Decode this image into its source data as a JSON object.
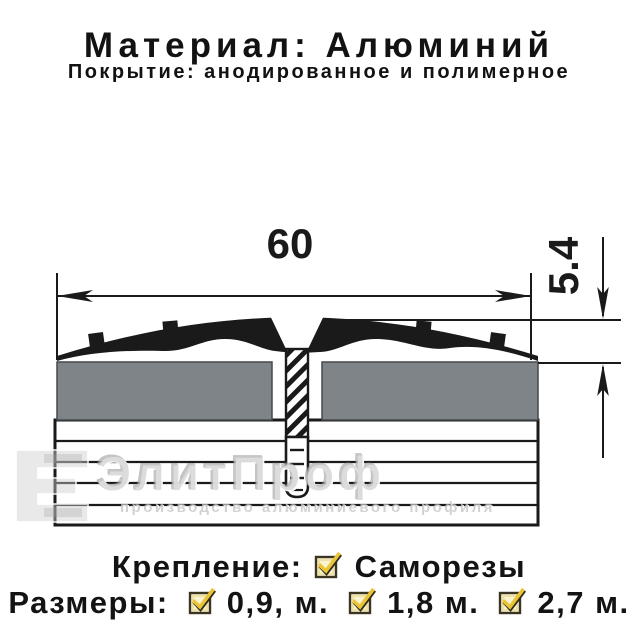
{
  "header": {
    "title": "Материал: Алюминий",
    "subtitle": "Покрытие: анодированное и полимерное"
  },
  "diagram": {
    "type": "threshold-profile-cross-section",
    "width_mm": "60",
    "height_mm": "5.4",
    "parts": [
      "aluminium-profile",
      "countersunk-self-tapping-screw",
      "floor-panels",
      "subfloor-layers"
    ]
  },
  "watermark": {
    "brand": "ЭлитПроф",
    "tagline": "производство алюминиевого профиля"
  },
  "footer": {
    "fastening_label": "Крепление:",
    "fastening_value": "Саморезы",
    "sizes_label": "Размеры:",
    "sizes": [
      "0,9, м.",
      "1,8 м.",
      "2,7 м."
    ]
  },
  "colors": {
    "ink": "#1a1a1a",
    "panel_gray": "#7e8487",
    "watermark_gray": "#c8c8c8",
    "check_yellow": "#e9c437",
    "checkbox_fill": "#faf3d2"
  }
}
